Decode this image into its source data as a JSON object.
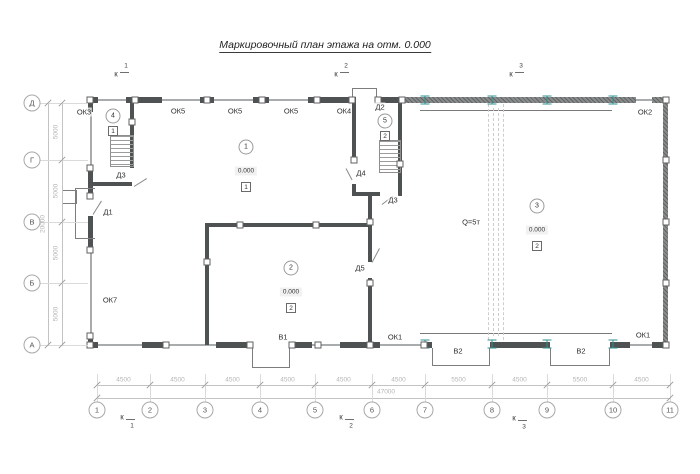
{
  "title": "Маркировочный план этажа на отм. 0.000",
  "colors": {
    "wall_dark": "#4f5252",
    "wall_light": "#a9acac",
    "column_accent": "#2f9090",
    "dimension": "#b5b5b5",
    "label": "#2e2e2e"
  },
  "crane": {
    "label": "Q=5т",
    "x": 471,
    "y": 222
  },
  "axes": {
    "columns": [
      {
        "label": "1",
        "x": 97
      },
      {
        "label": "2",
        "x": 150
      },
      {
        "label": "3",
        "x": 205
      },
      {
        "label": "4",
        "x": 260
      },
      {
        "label": "5",
        "x": 315
      },
      {
        "label": "6",
        "x": 372
      },
      {
        "label": "7",
        "x": 425
      },
      {
        "label": "8",
        "x": 492
      },
      {
        "label": "9",
        "x": 547
      },
      {
        "label": "10",
        "x": 613
      },
      {
        "label": "11",
        "x": 670
      }
    ],
    "rows": [
      {
        "label": "Д",
        "y": 103
      },
      {
        "label": "Г",
        "y": 160
      },
      {
        "label": "В",
        "y": 222
      },
      {
        "label": "Б",
        "y": 283
      },
      {
        "label": "А",
        "y": 345
      }
    ]
  },
  "dimensions": {
    "bottom_segments": [
      "4500",
      "4500",
      "4500",
      "4500",
      "4500",
      "4500",
      "5500",
      "4500",
      "5500",
      "4500"
    ],
    "bottom_total": "47000",
    "left_segments": [
      "5000",
      "5000",
      "5000",
      "5000"
    ],
    "left_total": "20000"
  },
  "section_marks": {
    "letter": "к",
    "top": [
      {
        "num": "1",
        "x": 116,
        "y": 74
      },
      {
        "num": "2",
        "x": 336,
        "y": 74
      },
      {
        "num": "3",
        "x": 511,
        "y": 74
      }
    ],
    "bottom": [
      {
        "num": "1",
        "x": 122,
        "y": 417
      },
      {
        "num": "2",
        "x": 341,
        "y": 417
      },
      {
        "num": "3",
        "x": 514,
        "y": 418
      }
    ]
  },
  "opening_labels": [
    {
      "text": "ОК3",
      "x": 84,
      "y": 112
    },
    {
      "text": "ОК5",
      "x": 178,
      "y": 111
    },
    {
      "text": "ОК5",
      "x": 235,
      "y": 111
    },
    {
      "text": "ОК5",
      "x": 291,
      "y": 111
    },
    {
      "text": "ОК4",
      "x": 344,
      "y": 111
    },
    {
      "text": "Д2",
      "x": 380,
      "y": 107
    },
    {
      "text": "ОК2",
      "x": 645,
      "y": 112
    },
    {
      "text": "Д3",
      "x": 121,
      "y": 175
    },
    {
      "text": "Д1",
      "x": 108,
      "y": 212
    },
    {
      "text": "Д4",
      "x": 361,
      "y": 173
    },
    {
      "text": "Д3",
      "x": 393,
      "y": 200
    },
    {
      "text": "Д5",
      "x": 360,
      "y": 268
    },
    {
      "text": "ОК7",
      "x": 110,
      "y": 300
    },
    {
      "text": "В1",
      "x": 283,
      "y": 337
    },
    {
      "text": "ОК1",
      "x": 395,
      "y": 337
    },
    {
      "text": "В2",
      "x": 458,
      "y": 351
    },
    {
      "text": "В2",
      "x": 581,
      "y": 351
    },
    {
      "text": "ОК1",
      "x": 643,
      "y": 335
    }
  ],
  "rooms": [
    {
      "num": "1",
      "elev": "0.000",
      "floor_type": "1",
      "x": 246,
      "y": 147
    },
    {
      "num": "2",
      "elev": "0.000",
      "floor_type": "2",
      "x": 291,
      "y": 268
    },
    {
      "num": "3",
      "elev": "0.000",
      "floor_type": "2",
      "x": 537,
      "y": 206
    },
    {
      "num": "4",
      "floor_type": "1",
      "x": 113,
      "y": 116
    },
    {
      "num": "5",
      "floor_type": "2",
      "x": 385,
      "y": 121
    }
  ]
}
